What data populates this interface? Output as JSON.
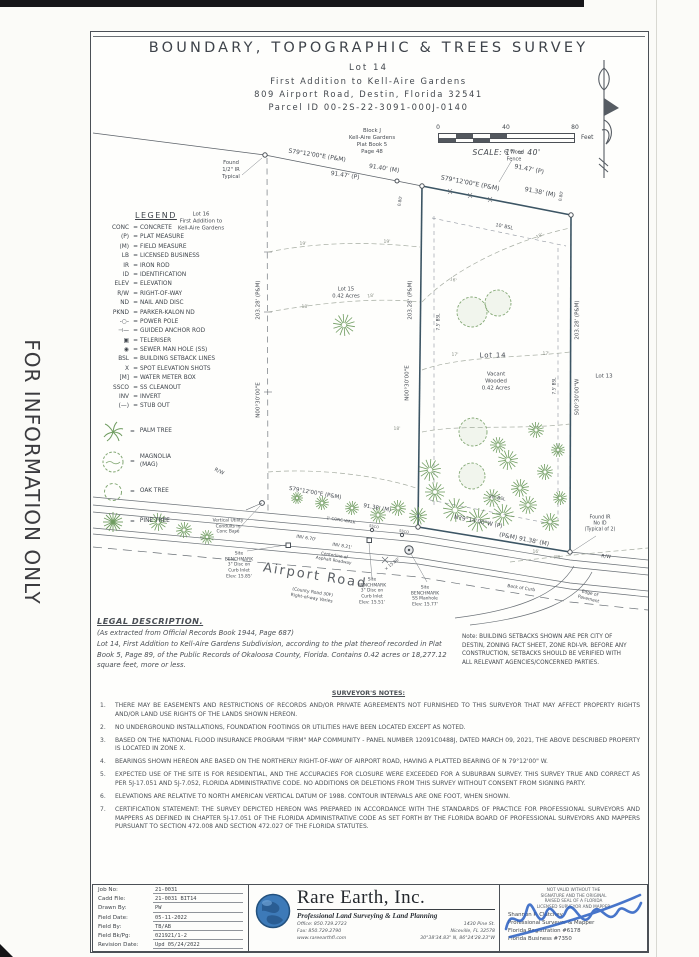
{
  "stamp": {
    "vertical_text": "FOR INFORMATION ONLY"
  },
  "title_block": {
    "title": "BOUNDARY,  TOPOGRAPHIC  &  TREES  SURVEY",
    "lot_line": "Lot  14",
    "subdivision_line": "First  Addition  to  Kell-Aire  Gardens",
    "address_line": "809  Airport  Road,  Destin,  Florida  32541",
    "parcel_line": "Parcel  ID  00-2S-22-3091-000J-0140"
  },
  "scale_bar": {
    "ticks": [
      "0",
      "40",
      "80"
    ],
    "unit": "Feet",
    "label": "SCALE: 1\" = 40'"
  },
  "legend": {
    "heading": "LEGEND",
    "eq": "=",
    "items": [
      {
        "abbr": "CONC",
        "desc": "CONCRETE"
      },
      {
        "abbr": "(P)",
        "desc": "PLAT MEASURE"
      },
      {
        "abbr": "(M)",
        "desc": "FIELD MEASURE"
      },
      {
        "abbr": "LB",
        "desc": "LICENSED BUSINESS"
      },
      {
        "abbr": "IR",
        "desc": "IRON ROD"
      },
      {
        "abbr": "ID",
        "desc": "IDENTIFICATION"
      },
      {
        "abbr": "ELEV",
        "desc": "ELEVATION"
      },
      {
        "abbr": "R/W",
        "desc": "RIGHT-OF-WAY"
      },
      {
        "abbr": "ND",
        "desc": "NAIL AND DISC"
      },
      {
        "abbr": "PKND",
        "desc": "PARKER-KALON ND"
      },
      {
        "abbr": "-○-",
        "desc": "POWER POLE"
      },
      {
        "abbr": "⊣—",
        "desc": "GUIDED ANCHOR ROD"
      },
      {
        "abbr": "▣",
        "desc": "TELERISER"
      },
      {
        "abbr": "◉",
        "desc": "SEWER MAN HOLE (SS)"
      },
      {
        "abbr": "BSL",
        "desc": "BUILDING SETBACK LINES"
      },
      {
        "abbr": "X",
        "desc": "SPOT ELEVATION SHOTS"
      },
      {
        "abbr": "[M]",
        "desc": "WATER METER BOX"
      },
      {
        "abbr": "SSCO",
        "desc": "SS CLEANOUT"
      },
      {
        "abbr": "INV",
        "desc": "INVERT"
      },
      {
        "abbr": "(—)",
        "desc": "STUB OUT"
      }
    ],
    "trees": [
      {
        "desc": "PALM TREE"
      },
      {
        "desc": "MAGNOLIA\n(MAG)"
      },
      {
        "desc": "OAK TREE"
      },
      {
        "desc": "PINE TREE"
      }
    ]
  },
  "drawing": {
    "labels": [
      {
        "t": "Block J\nKell-Aire Gardens\nPlat Book 5\nPage 48",
        "x": 372,
        "y": 142,
        "s": 5.4
      },
      {
        "t": "Found\n1/2\" IR\nTypical",
        "x": 231,
        "y": 170,
        "s": 5.2
      },
      {
        "t": "S79°12'00\"E  (P&M)",
        "x": 317,
        "y": 156,
        "r": 9,
        "s": 6
      },
      {
        "t": "91.40' (M)",
        "x": 384,
        "y": 169,
        "r": 9,
        "s": 6
      },
      {
        "t": "91.47' (P)",
        "x": 345,
        "y": 176,
        "r": 9,
        "s": 6
      },
      {
        "t": "6' Wood\nFence",
        "x": 514,
        "y": 156,
        "s": 5
      },
      {
        "t": "S79°12'00\"E (P&M)",
        "x": 470,
        "y": 184,
        "r": 11,
        "s": 6.2
      },
      {
        "t": "91.47' (P)",
        "x": 529,
        "y": 170,
        "r": 11,
        "s": 6.2
      },
      {
        "t": "91.38' (M)",
        "x": 540,
        "y": 193,
        "r": 11,
        "s": 6.2
      },
      {
        "t": "0.80'",
        "x": 561,
        "y": 196,
        "r": -80,
        "s": 4.2
      },
      {
        "t": "0.80'",
        "x": 400,
        "y": 201,
        "r": -80,
        "s": 4.2
      },
      {
        "t": "10' BSL",
        "x": 504,
        "y": 228,
        "r": 11,
        "s": 4.8
      },
      {
        "t": "Lot 16\nFirst Addition to\nKell-Aire Gardens",
        "x": 201,
        "y": 222,
        "s": 5.4
      },
      {
        "t": "203.28' (P&M)",
        "x": 259,
        "y": 300,
        "r": -90,
        "s": 5.5
      },
      {
        "t": "N00°30'00\"E",
        "x": 259,
        "y": 400,
        "r": -90,
        "s": 5.5
      },
      {
        "t": "Lot 15\n0.42 Acres",
        "x": 346,
        "y": 293,
        "s": 5.2
      },
      {
        "t": "203.28' (P&M)",
        "x": 411,
        "y": 300,
        "r": -90,
        "s": 5.5
      },
      {
        "t": "N00°30'00\"E",
        "x": 408,
        "y": 383,
        "r": -90,
        "s": 5.5
      },
      {
        "t": "7.5' BSL",
        "x": 438,
        "y": 322,
        "r": -90,
        "s": 4.2
      },
      {
        "t": "7.5' BSL",
        "x": 554,
        "y": 386,
        "r": -90,
        "s": 4.2
      },
      {
        "t": "Lot 14",
        "x": 493,
        "y": 356,
        "s": 7,
        "c": "lot"
      },
      {
        "t": "Vacant\nWooded\n0.42 Acres",
        "x": 496,
        "y": 382,
        "s": 5.4
      },
      {
        "t": "203.28' (P&M)",
        "x": 578,
        "y": 320,
        "r": -90,
        "s": 5.5
      },
      {
        "t": "S00°30'00\"W",
        "x": 578,
        "y": 397,
        "r": -90,
        "s": 5.5
      },
      {
        "t": "Lot 13",
        "x": 604,
        "y": 377,
        "s": 5.5
      },
      {
        "t": "R/W",
        "x": 219,
        "y": 472,
        "r": 25,
        "s": 5
      },
      {
        "t": "R/W",
        "x": 606,
        "y": 558,
        "r": 6,
        "s": 4.8
      },
      {
        "t": "19'",
        "x": 303,
        "y": 245,
        "s": 4.5,
        "c": "ctl"
      },
      {
        "t": "19'",
        "x": 387,
        "y": 243,
        "s": 4.5,
        "c": "ctl"
      },
      {
        "t": "18'",
        "x": 371,
        "y": 297,
        "r": -8,
        "s": 4.5,
        "c": "ctl"
      },
      {
        "t": "18'",
        "x": 305,
        "y": 308,
        "s": 4.5,
        "c": "ctl"
      },
      {
        "t": "18'",
        "x": 540,
        "y": 237,
        "r": -28,
        "s": 4.5,
        "c": "ctl"
      },
      {
        "t": "16'",
        "x": 453,
        "y": 281,
        "r": 15,
        "s": 4.5,
        "c": "ctl"
      },
      {
        "t": "17'",
        "x": 455,
        "y": 356,
        "s": 4.5,
        "c": "ctl"
      },
      {
        "t": "17'",
        "x": 546,
        "y": 355,
        "s": 4.5,
        "c": "ctl"
      },
      {
        "t": "18'",
        "x": 397,
        "y": 430,
        "s": 4.5,
        "c": "ctl"
      },
      {
        "t": "16'",
        "x": 536,
        "y": 553,
        "s": 4.5,
        "c": "ctl"
      },
      {
        "t": "(M)",
        "x": 557,
        "y": 557,
        "s": 4.2,
        "c": "ctl"
      },
      {
        "t": "20' BSL",
        "x": 497,
        "y": 499,
        "r": 10,
        "s": 4.5
      },
      {
        "t": "S79°12'00\"E (P&M)",
        "x": 315,
        "y": 494,
        "r": 10,
        "s": 5.5
      },
      {
        "t": "91.38' (M)",
        "x": 377,
        "y": 509,
        "r": 10,
        "s": 5.5
      },
      {
        "t": "N79°14'00\"W (P)",
        "x": 478,
        "y": 523,
        "r": 11,
        "s": 5.8
      },
      {
        "t": "(P&M)  91.38' (M)",
        "x": 524,
        "y": 540,
        "r": 11,
        "s": 6
      },
      {
        "t": "Found IR\nNo ID\n(Typical of 2)",
        "x": 600,
        "y": 525,
        "s": 4.8
      },
      {
        "t": "Vertical Utility\nConduits in\nConc Base",
        "x": 228,
        "y": 527,
        "s": 4.4
      },
      {
        "t": "Site\nBENCHMARK\n3\" Disc on\nCurb Inlet\nElev: 15.85'",
        "x": 239,
        "y": 566,
        "s": 4.4
      },
      {
        "t": "1' CONC WALK",
        "x": 341,
        "y": 520,
        "r": 9,
        "s": 4
      },
      {
        "t": "SSCO",
        "x": 374,
        "y": 527,
        "r": 9,
        "s": 3.6
      },
      {
        "t": "SSCO",
        "x": 404,
        "y": 532,
        "r": 9,
        "s": 3.6
      },
      {
        "t": "INV 6.70'",
        "x": 306,
        "y": 539,
        "r": 9,
        "s": 4.4
      },
      {
        "t": "INV 8.21'",
        "x": 342,
        "y": 547,
        "r": 9,
        "s": 4.4
      },
      {
        "t": "Centerline of\nAsphalt Roadway",
        "x": 334,
        "y": 558,
        "r": 9,
        "s": 4.2
      },
      {
        "t": "Airport Road",
        "x": 315,
        "y": 577,
        "r": 9,
        "s": 13,
        "c": "road"
      },
      {
        "t": "(County Road 30F)\nRight-of-way Varies",
        "x": 312,
        "y": 596,
        "r": 9,
        "s": 4.4
      },
      {
        "t": "× 15.80'",
        "x": 392,
        "y": 564,
        "r": -38,
        "s": 4.2
      },
      {
        "t": "Site\nBENCHMARK\n3\" Disc on\nCurb Inlet\nElev: 15.51'",
        "x": 372,
        "y": 592,
        "s": 4.4
      },
      {
        "t": "Site\nBENCHMARK\nSS Manhole\nElev: 15.77'",
        "x": 425,
        "y": 597,
        "s": 4.4
      },
      {
        "t": "Back of Curb",
        "x": 521,
        "y": 589,
        "r": 9,
        "s": 4.4
      },
      {
        "t": "Edge of\nPavement",
        "x": 589,
        "y": 597,
        "r": 14,
        "s": 4.4
      }
    ],
    "trees": [
      {
        "k": "oak",
        "x": 472,
        "y": 312,
        "r": 15
      },
      {
        "k": "oak",
        "x": 498,
        "y": 303,
        "r": 13
      },
      {
        "k": "pine",
        "x": 344,
        "y": 325,
        "r": 11
      },
      {
        "k": "oak",
        "x": 473,
        "y": 432,
        "r": 14
      },
      {
        "k": "oak",
        "x": 472,
        "y": 476,
        "r": 13
      },
      {
        "k": "pine",
        "x": 430,
        "y": 470,
        "r": 11
      },
      {
        "k": "pine",
        "x": 508,
        "y": 460,
        "r": 10
      },
      {
        "k": "pine",
        "x": 520,
        "y": 488,
        "r": 9
      },
      {
        "k": "pine",
        "x": 545,
        "y": 472,
        "r": 8
      },
      {
        "k": "pine",
        "x": 498,
        "y": 445,
        "r": 8
      },
      {
        "k": "pine",
        "x": 536,
        "y": 430,
        "r": 8
      },
      {
        "k": "pine",
        "x": 558,
        "y": 450,
        "r": 7
      },
      {
        "k": "pine",
        "x": 435,
        "y": 492,
        "r": 10
      },
      {
        "k": "pine",
        "x": 455,
        "y": 510,
        "r": 12
      },
      {
        "k": "pine",
        "x": 478,
        "y": 520,
        "r": 12
      },
      {
        "k": "pine",
        "x": 503,
        "y": 515,
        "r": 11
      },
      {
        "k": "pine",
        "x": 528,
        "y": 505,
        "r": 9
      },
      {
        "k": "pine",
        "x": 550,
        "y": 522,
        "r": 9
      },
      {
        "k": "pine",
        "x": 560,
        "y": 498,
        "r": 7
      },
      {
        "k": "pine",
        "x": 492,
        "y": 498,
        "r": 9
      },
      {
        "k": "pine",
        "x": 418,
        "y": 516,
        "r": 9
      },
      {
        "k": "pine",
        "x": 398,
        "y": 508,
        "r": 8
      },
      {
        "k": "pine",
        "x": 378,
        "y": 515,
        "r": 8
      },
      {
        "k": "pine",
        "x": 352,
        "y": 508,
        "r": 7
      },
      {
        "k": "pine",
        "x": 322,
        "y": 503,
        "r": 7
      },
      {
        "k": "pine",
        "x": 297,
        "y": 498,
        "r": 6
      },
      {
        "k": "pine",
        "x": 158,
        "y": 522,
        "r": 9
      },
      {
        "k": "pine",
        "x": 184,
        "y": 530,
        "r": 8
      },
      {
        "k": "pine",
        "x": 207,
        "y": 537,
        "r": 7
      }
    ]
  },
  "legal": {
    "heading": "LEGAL DESCRIPTION.",
    "source_line": "(As extracted from Official Records Book 1944, Page 687)",
    "body": "Lot 14, First Addition to Kell-Aire Gardens Subdivision, according to the plat thereof recorded in Plat Book 5, Page 89, of the Public Records of Okaloosa County, Florida. Contains 0.42 acres or 18,277.12 square feet, more or less."
  },
  "setback_note": "Note:  BUILDING SETBACKS SHOWN ARE PER CITY OF DESTIN, ZONING FACT SHEET, ZONE RDI-VR.  BEFORE ANY CONSTRUCTION, SETBACKS SHOULD BE VERIFIED WITH ALL RELEVANT AGENCIES/CONCERNED PARTIES.",
  "notes": {
    "heading": "SURVEYOR'S NOTES:",
    "items": [
      {
        "num": "1.",
        "text": "THERE MAY BE EASEMENTS AND RESTRICTIONS OF RECORDS AND/OR PRIVATE AGREEMENTS NOT FURNISHED TO THIS SURVEYOR THAT MAY AFFECT PROPERTY RIGHTS AND/OR LAND USE RIGHTS OF THE LANDS SHOWN HEREON."
      },
      {
        "num": "2.",
        "text": "NO UNDERGROUND INSTALLATIONS, FOUNDATION FOOTINGS OR UTILITIES HAVE BEEN LOCATED EXCEPT AS NOTED."
      },
      {
        "num": "3.",
        "text": "BASED ON THE NATIONAL FLOOD INSURANCE PROGRAM \"FIRM\" MAP COMMUNITY - PANEL NUMBER 12091C0488J, DATED MARCH 09, 2021, THE ABOVE DESCRIBED PROPERTY IS LOCATED IN ZONE X."
      },
      {
        "num": "4.",
        "text": "BEARINGS SHOWN HEREON ARE BASED ON THE NORTHERLY RIGHT-OF-WAY OF AIRPORT ROAD, HAVING A PLATTED BEARING OF N 79°12'00\" W."
      },
      {
        "num": "5.",
        "text": "EXPECTED USE OF THE SITE IS FOR RESIDENTIAL, AND THE ACCURACIES FOR CLOSURE WERE EXCEEDED FOR A SUBURBAN SURVEY. THIS SURVEY TRUE AND CORRECT AS PER 5J-17.051 AND 5J-7.052, FLORIDA ADMINISTRATIVE CODE.  NO ADDITIONS OR DELETIONS FROM THIS SURVEY WITHOUT CONSENT FROM SIGNING PARTY."
      },
      {
        "num": "6.",
        "text": "ELEVATIONS ARE RELATIVE TO NORTH AMERICAN VERTICAL DATUM OF 1988. CONTOUR INTERVALS ARE ONE FOOT, WHEN SHOWN."
      },
      {
        "num": "7.",
        "text": "CERTIFICATION STATEMENT:  THE SURVEY DEPICTED HEREON WAS PREPARED IN ACCORDANCE WITH THE STANDARDS OF PRACTICE FOR PROFESSIONAL SURVEYORS AND MAPPERS AS DEFINED IN CHAPTER 5J-17.051 OF THE FLORIDA ADMINISTRATIVE CODE AS SET FORTH BY THE FLORIDA BOARD OF PROFESSIONAL SURVEYORS AND MAPPERS PURSUANT TO SECTION 472.008 AND SECTION 472.027 OF THE FLORIDA STATUTES."
      }
    ]
  },
  "footer": {
    "info": {
      "rows": [
        {
          "label": "Job No:",
          "value": "21-0031"
        },
        {
          "label": "Cadd File:",
          "value": "21-0031 BIT14"
        },
        {
          "label": "Drawn By:",
          "value": "PW"
        },
        {
          "label": "Field Date:",
          "value": "05-11-2022"
        },
        {
          "label": "Field By:",
          "value": "TB/AB"
        },
        {
          "label": "Field Bk/Pg:",
          "value": "021921/1-2"
        },
        {
          "label": "Revision Date:",
          "value": "Upd 05/24/2022"
        }
      ]
    },
    "company": {
      "name": "Rare Earth, Inc.",
      "tagline": "Professional Land Surveying & Land Planning",
      "contact_left": [
        "Office: 850.729.2723",
        "Fax: 850.729.2790",
        "www.rareearthfl.com"
      ],
      "contact_right": [
        "1430 Pine St.",
        "Niceville, FL 32578",
        "30°38'34.83\" N, 86°24'28.23\"W"
      ]
    },
    "certification": {
      "disclaimer_lines": [
        "NOT VALID WITHOUT THE",
        "SIGNATURE AND THE ORIGINAL",
        "RAISED SEAL OF A FLORIDA",
        "LICENSED SURVEYOR AND MAPPER"
      ],
      "name": "Shannon P. Clatchey",
      "title": "Professional Surveyor & Mapper",
      "registration": "Florida Registration #6178",
      "business": "Florida Business #7350"
    }
  }
}
